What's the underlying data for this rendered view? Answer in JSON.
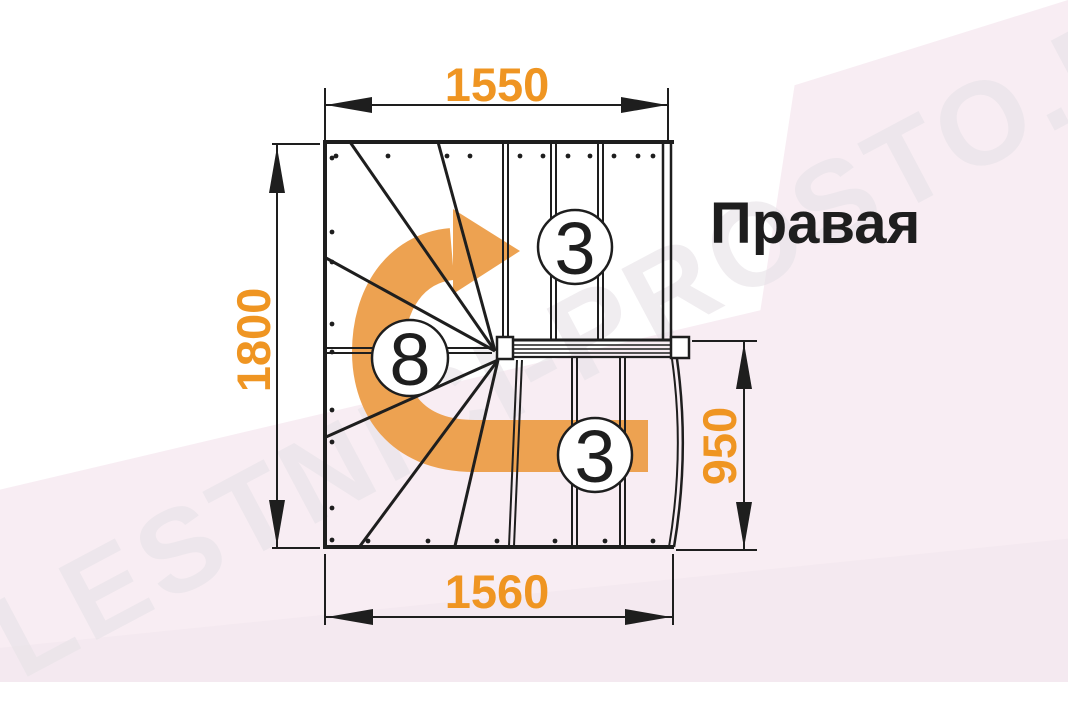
{
  "watermark": {
    "text": "LESTNICI-PROSTO.RU"
  },
  "plan": {
    "direction_label": "Правая",
    "dimensions": {
      "top": "1550",
      "left": "1800",
      "right": "950",
      "bottom": "1560"
    },
    "step_counts": {
      "upper_flight": "3",
      "winders": "8",
      "lower_flight": "3"
    }
  },
  "colors": {
    "dimension_text": "#ef9522",
    "direction_arrow": "#eda251",
    "drawing_line": "#1e1e1e",
    "background_tint": "#f8edf3"
  }
}
